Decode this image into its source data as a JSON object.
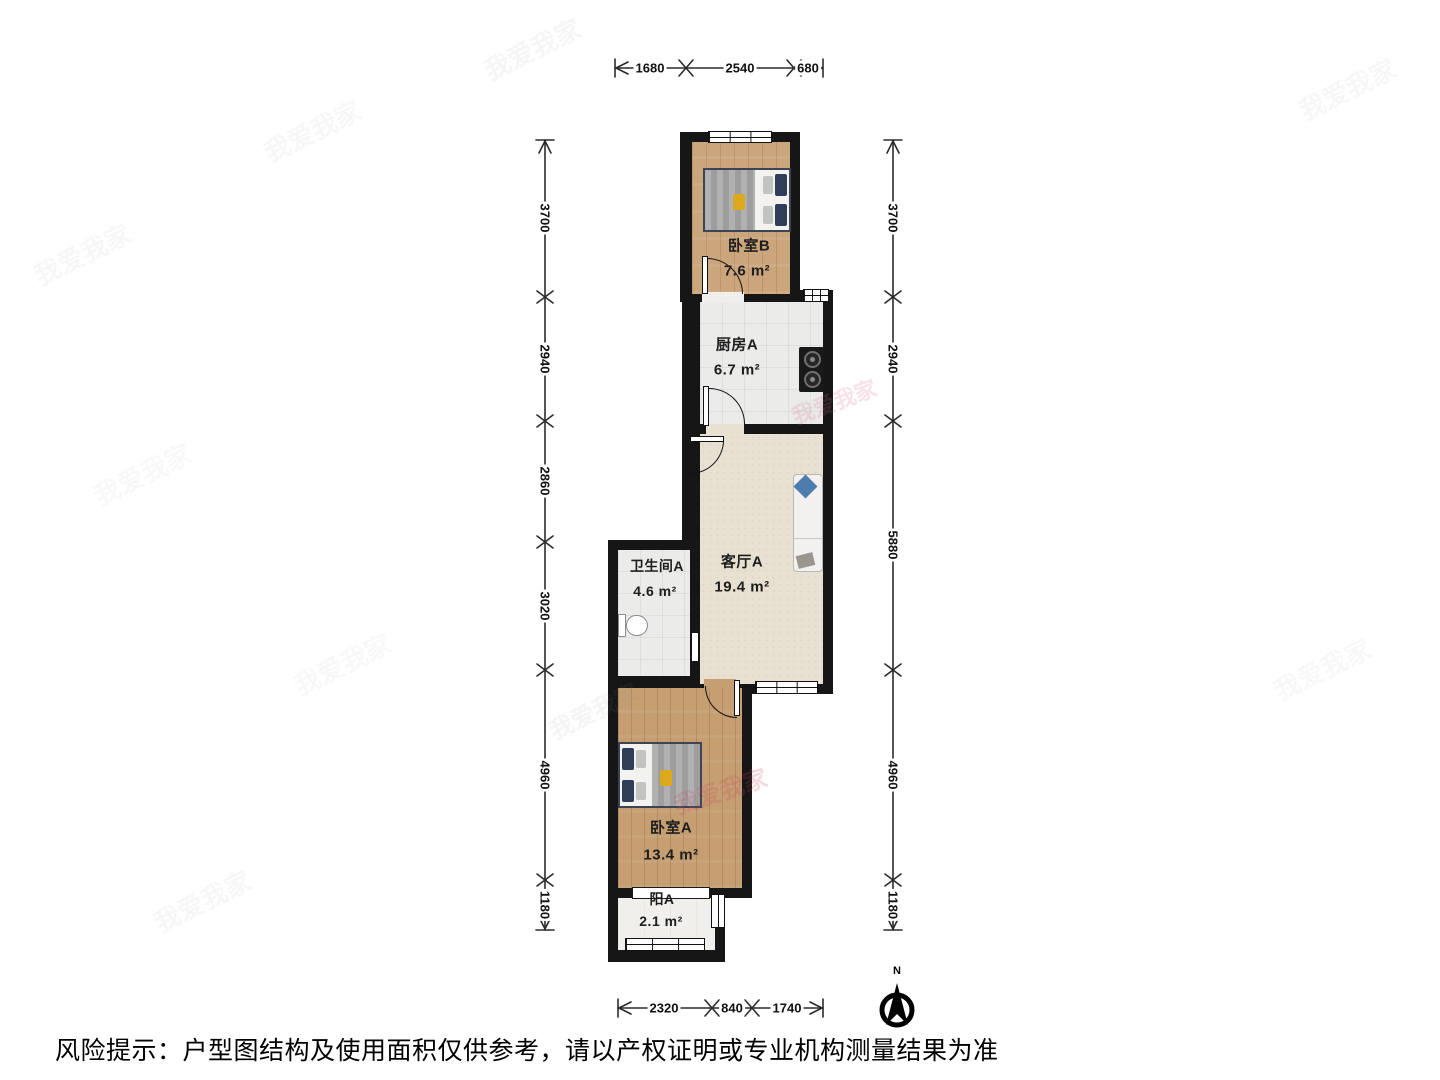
{
  "disclaimer": "风险提示：户型图结构及使用面积仅供参考，请以产权证明或专业机构测量结果为准",
  "compass": {
    "north_label": "N"
  },
  "watermark": {
    "text": "我爱我家"
  },
  "rooms": [
    {
      "id": "bedroom-b",
      "name": "卧室B",
      "area": "7.6 m²"
    },
    {
      "id": "kitchen-a",
      "name": "厨房A",
      "area": "6.7 m²"
    },
    {
      "id": "living-a",
      "name": "客厅A",
      "area": "19.4 m²"
    },
    {
      "id": "bathroom-a",
      "name": "卫生间A",
      "area": "4.6 m²"
    },
    {
      "id": "bedroom-a",
      "name": "卧室A",
      "area": "13.4 m²"
    },
    {
      "id": "balcony-a",
      "name": "阳A",
      "area": "2.1 m²"
    }
  ],
  "dims": {
    "top": [
      "1680",
      "2540",
      "680"
    ],
    "bottom": [
      "2320",
      "840",
      "1740"
    ],
    "left": [
      "3700",
      "2940",
      "2860",
      "3020",
      "4960",
      "1180"
    ],
    "right": [
      "3700",
      "2940",
      "5880",
      "4960",
      "1180"
    ]
  },
  "palette": {
    "wall": "#161616",
    "wood_floor": "#cba67c",
    "wood_floor_dark": "#c59e72",
    "tile_floor": "#ebebe9",
    "living_floor": "#e8e1d2",
    "balcony_floor": "#f0efeb",
    "bed_pillow_navy": "#2f3d59",
    "sofa_pillow_blue": "#4d7dad",
    "highlight_yellow": "#dca91c",
    "watermark_red": "#cc4455"
  }
}
